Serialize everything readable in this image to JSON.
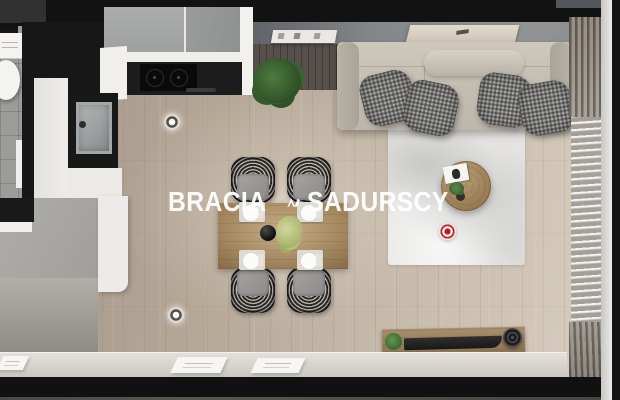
{
  "watermark": {
    "left": "BRACIA",
    "right": "SADURSCY",
    "logo": "mountain-peaks-logo",
    "color": "#ffffff"
  },
  "scene": {
    "view": "top-down 3D render of an apartment living room with open kitchen",
    "rooms": [
      "kitchen",
      "living-dining-area",
      "bathroom-glimpse"
    ],
    "objects": [
      "sofa",
      "throw-pillows",
      "bolster-cushion",
      "area-rug",
      "round-coffee-table",
      "magazine",
      "potted-plant-large",
      "potted-plant-small",
      "dining-table",
      "dining-chairs",
      "place-settings",
      "black-bowl",
      "kitchen-upper-cabinets",
      "induction-cooktop",
      "kitchen-sink",
      "tall-white-cabinet",
      "wardrobe-unit",
      "toilet",
      "bathroom-tiles",
      "ceiling-spotlights",
      "tv-bench",
      "tv-panel",
      "round-speaker",
      "sheer-curtain",
      "window-sill",
      "wall-art-frame",
      "wall-shelf",
      "hotspot-marker",
      "sill-books"
    ],
    "colors": {
      "floor_wood": "#b9ab9a",
      "wall_dark": "#161616",
      "wall_top_gray": "#84878a",
      "sofa": "#c6bfb4",
      "pillow": "#72716f",
      "rug": "#e4e3e1",
      "dining_table": "#97794f",
      "coffee_table": "#a98a62",
      "cabinet_gray": "#a4a6a5",
      "cabinet_white": "#efeeec",
      "countertop_black": "#1c1c1c",
      "curtain": "#b0aba3",
      "sill": "#d9d5cf",
      "hotspot_red": "#c81b22",
      "plant_green": "#3f6b35",
      "watermark_white": "#ffffff"
    }
  }
}
